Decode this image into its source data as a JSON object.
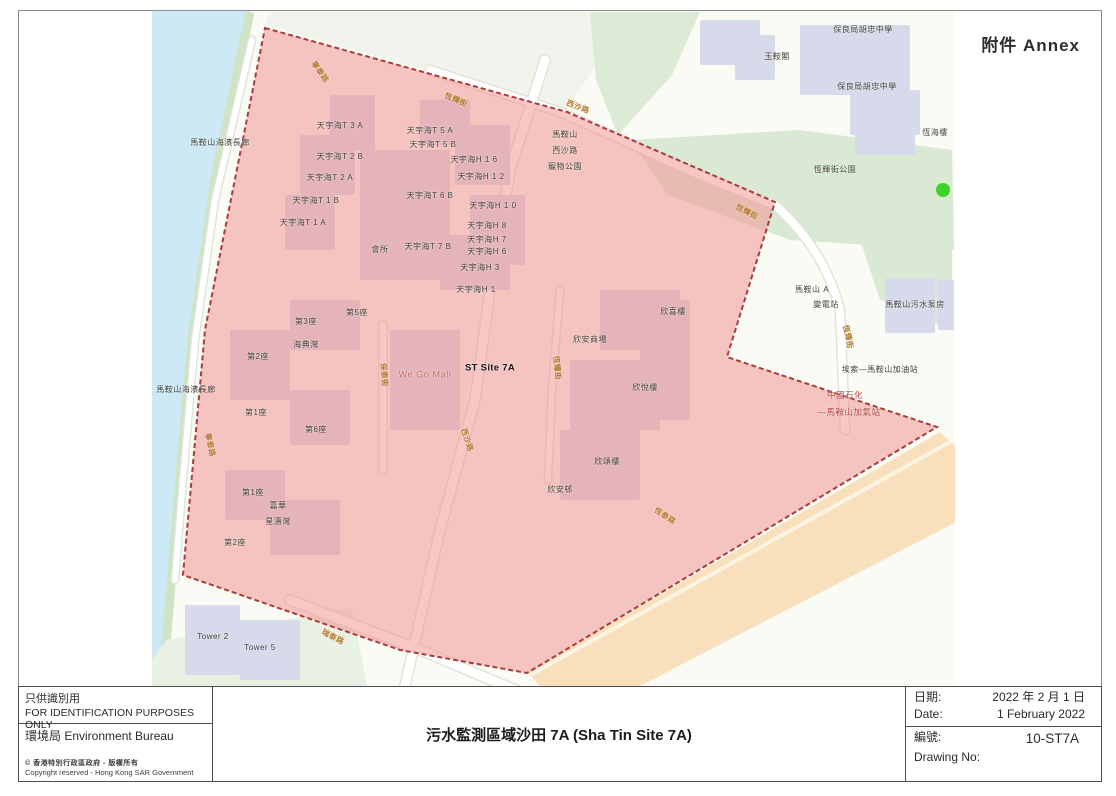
{
  "annex_label": "附件 Annex",
  "map": {
    "green_dot_color": "#3ed32a",
    "zone_fill": "rgba(242,146,143,0.52)",
    "zone_border": "#a83d3d",
    "labels": [
      {
        "t": "馬鞍山海濱長廊",
        "x": 220,
        "y": 143,
        "cls": "bld",
        "name": "label-promenade"
      },
      {
        "t": "保良局胡忠中學",
        "x": 863,
        "y": 30,
        "cls": "bld",
        "name": "label-school"
      },
      {
        "t": "玉鞍閣",
        "x": 777,
        "y": 57,
        "cls": "bld",
        "name": "label-yuk-on-court"
      },
      {
        "t": "保良局胡忠中學",
        "x": 867,
        "y": 87,
        "cls": "bld",
        "name": "label-school"
      },
      {
        "t": "恆海樓",
        "x": 935,
        "y": 133,
        "cls": "bld",
        "name": "label-hang-hoi-house"
      },
      {
        "t": "恆輝街公園",
        "x": 835,
        "y": 170,
        "cls": "bld",
        "name": "label-hang-fai-street-park"
      },
      {
        "t": "馬鞍山",
        "x": 565,
        "y": 135,
        "cls": "bld",
        "name": "label-pet-garden"
      },
      {
        "t": "西沙路",
        "x": 565,
        "y": 151,
        "cls": "bld",
        "name": "label-pet-garden"
      },
      {
        "t": "寵物公園",
        "x": 565,
        "y": 167,
        "cls": "bld",
        "name": "label-pet-garden"
      },
      {
        "t": "天宇海T 3 A",
        "x": 340,
        "y": 126,
        "cls": "bld",
        "name": "label-oceanaire"
      },
      {
        "t": "天宇海T 5 A",
        "x": 430,
        "y": 131,
        "cls": "bld",
        "name": "label-oceanaire"
      },
      {
        "t": "天宇海T 5 B",
        "x": 433,
        "y": 145,
        "cls": "bld",
        "name": "label-oceanaire"
      },
      {
        "t": "天宇海T 2 B",
        "x": 340,
        "y": 157,
        "cls": "bld",
        "name": "label-oceanaire"
      },
      {
        "t": "天宇海H 1 6",
        "x": 474,
        "y": 160,
        "cls": "bld",
        "name": "label-oceanaire"
      },
      {
        "t": "天宇海T 2 A",
        "x": 330,
        "y": 178,
        "cls": "bld",
        "name": "label-oceanaire"
      },
      {
        "t": "天宇海H 1 2",
        "x": 481,
        "y": 177,
        "cls": "bld",
        "name": "label-oceanaire"
      },
      {
        "t": "天宇海T 1 B",
        "x": 316,
        "y": 201,
        "cls": "bld",
        "name": "label-oceanaire"
      },
      {
        "t": "天宇海T 6 B",
        "x": 430,
        "y": 196,
        "cls": "bld",
        "name": "label-oceanaire"
      },
      {
        "t": "天宇海H 1 0",
        "x": 493,
        "y": 206,
        "cls": "bld",
        "name": "label-oceanaire"
      },
      {
        "t": "天宇海T 1 A",
        "x": 303,
        "y": 223,
        "cls": "bld",
        "name": "label-oceanaire"
      },
      {
        "t": "天宇海H 8",
        "x": 487,
        "y": 226,
        "cls": "bld",
        "name": "label-oceanaire"
      },
      {
        "t": "天宇海H 7",
        "x": 487,
        "y": 240,
        "cls": "bld",
        "name": "label-oceanaire"
      },
      {
        "t": "會所",
        "x": 380,
        "y": 250,
        "cls": "bld",
        "name": "label-clubhouse"
      },
      {
        "t": "天宇海T 7 B",
        "x": 428,
        "y": 247,
        "cls": "bld",
        "name": "label-oceanaire"
      },
      {
        "t": "天宇海H 6",
        "x": 487,
        "y": 252,
        "cls": "bld",
        "name": "label-oceanaire"
      },
      {
        "t": "天宇海H 3",
        "x": 480,
        "y": 268,
        "cls": "bld",
        "name": "label-oceanaire"
      },
      {
        "t": "天宇海H 1",
        "x": 476,
        "y": 290,
        "cls": "bld",
        "name": "label-oceanaire"
      },
      {
        "t": "第5座",
        "x": 357,
        "y": 313,
        "cls": "bld",
        "name": "label-block5"
      },
      {
        "t": "第3座",
        "x": 306,
        "y": 322,
        "cls": "bld",
        "name": "label-block3"
      },
      {
        "t": "海典灣",
        "x": 306,
        "y": 345,
        "cls": "bld",
        "name": "label-marbella"
      },
      {
        "t": "第2座",
        "x": 258,
        "y": 357,
        "cls": "bld",
        "name": "label-block2"
      },
      {
        "t": "馬鞍山海濱長廊",
        "x": 186,
        "y": 390,
        "cls": "bld",
        "name": "label-promenade"
      },
      {
        "t": "第1座",
        "x": 256,
        "y": 413,
        "cls": "bld",
        "name": "label-block1"
      },
      {
        "t": "第6座",
        "x": 316,
        "y": 430,
        "cls": "bld",
        "name": "label-block6"
      },
      {
        "t": "ST Site 7A",
        "x": 490,
        "y": 368,
        "cls": "site",
        "name": "label-st-site-7a"
      },
      {
        "t": "We Go Mall",
        "x": 425,
        "y": 375,
        "cls": "mall",
        "name": "label-we-go-mall"
      },
      {
        "t": "欣喜樓",
        "x": 673,
        "y": 312,
        "cls": "bld",
        "name": "label-yan-hei-house"
      },
      {
        "t": "欣安商場",
        "x": 590,
        "y": 340,
        "cls": "bld",
        "name": "label-yan-on-shopping-centre"
      },
      {
        "t": "欣悅樓",
        "x": 645,
        "y": 388,
        "cls": "bld",
        "name": "label-yan-yuet-house"
      },
      {
        "t": "欣頌樓",
        "x": 607,
        "y": 462,
        "cls": "bld",
        "name": "label-yan-chung-house"
      },
      {
        "t": "欣安邨",
        "x": 560,
        "y": 490,
        "cls": "bld",
        "name": "label-yan-on-estate"
      },
      {
        "t": "第1座",
        "x": 253,
        "y": 493,
        "cls": "bld",
        "name": "label-block1"
      },
      {
        "t": "嘉華",
        "x": 278,
        "y": 506,
        "cls": "bld",
        "name": "label-kwah"
      },
      {
        "t": "星濤灣",
        "x": 278,
        "y": 522,
        "cls": "bld",
        "name": "label-the-sapphire"
      },
      {
        "t": "第2座",
        "x": 235,
        "y": 543,
        "cls": "bld",
        "name": "label-block2"
      },
      {
        "t": "Tower 2",
        "x": 213,
        "y": 637,
        "cls": "bld",
        "name": "label-tower2"
      },
      {
        "t": "Tower 5",
        "x": 260,
        "y": 648,
        "cls": "bld",
        "name": "label-tower5"
      },
      {
        "t": "馬鞍山  A",
        "x": 812,
        "y": 290,
        "cls": "bld",
        "name": "label-substation"
      },
      {
        "t": "變電站",
        "x": 826,
        "y": 305,
        "cls": "bld",
        "name": "label-substation"
      },
      {
        "t": "馬鞍山污水泵房",
        "x": 915,
        "y": 305,
        "cls": "bld",
        "name": "label-sewage-pumping-station"
      },
      {
        "t": "埃索—馬鞍山加油站",
        "x": 880,
        "y": 370,
        "cls": "bld",
        "name": "label-esso-petrol-station"
      },
      {
        "t": "中國石化",
        "x": 845,
        "y": 395,
        "cls": "brand",
        "name": "label-sinopec"
      },
      {
        "t": "—馬鞍山加氣站",
        "x": 849,
        "y": 412,
        "cls": "brand",
        "name": "label-sinopec-gas-station"
      },
      {
        "t": "寧泰路",
        "x": 320,
        "y": 72,
        "r": 55,
        "cls": "street",
        "name": "street-ning-tai-road"
      },
      {
        "t": "恆輝街",
        "x": 456,
        "y": 100,
        "r": 23,
        "cls": "street",
        "name": "street-hang-fai-street"
      },
      {
        "t": "西沙路",
        "x": 578,
        "y": 107,
        "r": 21,
        "cls": "street",
        "name": "street-sai-sha-road"
      },
      {
        "t": "恆輝街",
        "x": 747,
        "y": 212,
        "r": 27,
        "cls": "street",
        "name": "street-hang-fai-street"
      },
      {
        "t": "恆輝街",
        "x": 848,
        "y": 337,
        "r": 78,
        "cls": "street",
        "name": "street-hang-fai-street"
      },
      {
        "t": "恆耀街",
        "x": 557,
        "y": 368,
        "r": 84,
        "cls": "street",
        "name": "street-hang-yiu-street"
      },
      {
        "t": "保泰街",
        "x": 384,
        "y": 375,
        "r": 86,
        "cls": "street",
        "name": "street-po-tai-street"
      },
      {
        "t": "西沙路",
        "x": 467,
        "y": 440,
        "r": 72,
        "cls": "street",
        "name": "street-sai-sha-road"
      },
      {
        "t": "寧泰路",
        "x": 210,
        "y": 445,
        "r": 78,
        "cls": "street",
        "name": "street-ning-tai-road"
      },
      {
        "t": "恆泰路",
        "x": 665,
        "y": 516,
        "r": 33,
        "cls": "street",
        "name": "street-hang-tai-road"
      },
      {
        "t": "瑞泰路",
        "x": 333,
        "y": 637,
        "r": 27,
        "cls": "street",
        "name": "street-shui-tai-road"
      }
    ]
  },
  "footer": {
    "left": {
      "purpose_zh": "只供識別用",
      "purpose_en": "FOR IDENTIFICATION PURPOSES ONLY",
      "bureau": "環境局  Environment Bureau",
      "copyright_zh": "©  香港特別行政區政府 - 版權所有",
      "copyright_en": "Copyright reserved - Hong Kong SAR Government"
    },
    "title": "污水監測區域沙田 7A (Sha Tin Site 7A)",
    "right": {
      "date_label_zh": "日期:",
      "date_zh": "2022 年 2 月 1 日",
      "date_label_en": "Date:",
      "date_en": "1 February 2022",
      "no_label_zh": "編號:",
      "no_value": "10-ST7A",
      "no_label_en": "Drawing No:"
    }
  }
}
